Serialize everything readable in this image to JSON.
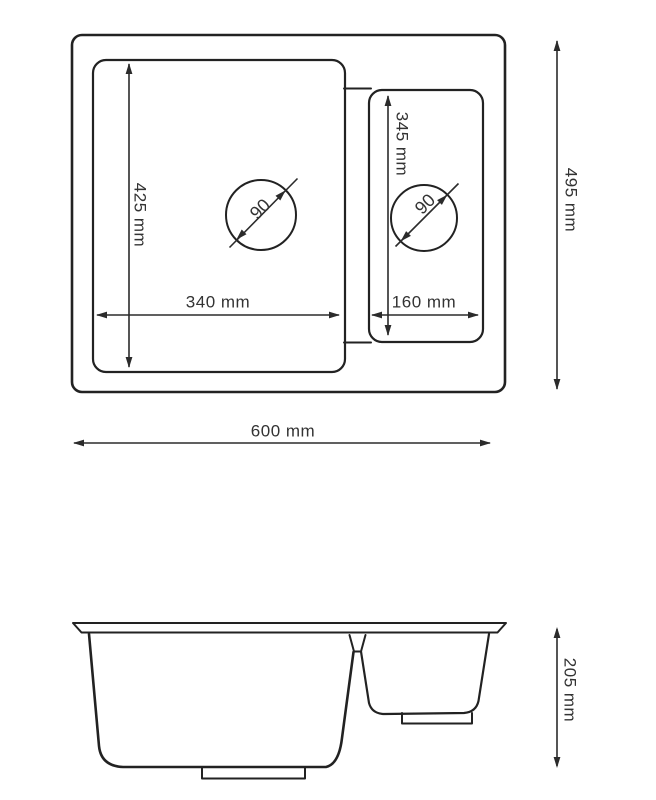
{
  "drawing": {
    "type": "technical-dimension-drawing",
    "subject": "double-bowl kitchen sink",
    "top_view": {
      "overall": {
        "width": "600 mm",
        "depth": "495 mm"
      },
      "main_bowl": {
        "inner_width": "340 mm",
        "inner_depth": "425 mm",
        "drain_diameter": "90"
      },
      "small_bowl": {
        "inner_width": "160 mm",
        "inner_depth": "345 mm",
        "drain_diameter": "90"
      }
    },
    "side_view": {
      "height": "205 mm"
    },
    "colors": {
      "line": "#222222",
      "dimension_line": "#2b2b2b",
      "text": "#333333",
      "background": "#ffffff"
    }
  }
}
